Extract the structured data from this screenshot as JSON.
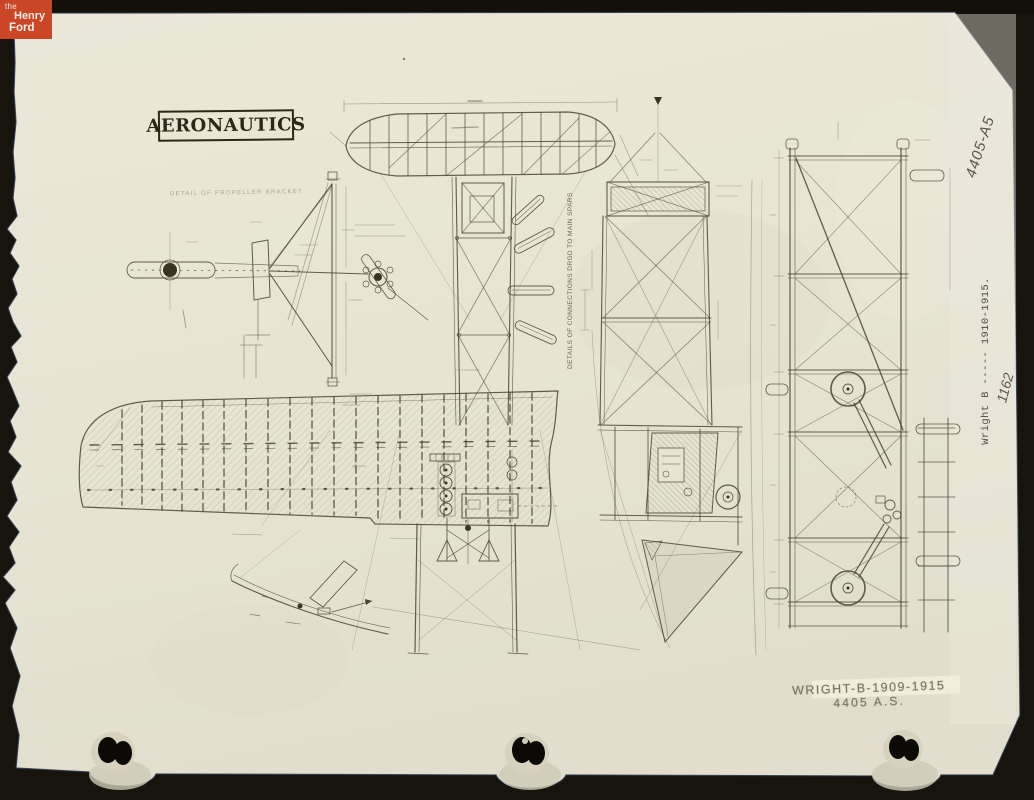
{
  "meta": {
    "background_color": "#17140d",
    "paper_color": "#e8e5d6",
    "ink_color": "#4a4334",
    "logo_color": "#cb4527"
  },
  "logo": {
    "word1": "the",
    "word2": "Henry",
    "word3": "Ford"
  },
  "drawing": {
    "masthead": "AERONAUTICS",
    "caption_propeller_bracket": "DETAIL OF PROPELLER BRACKET",
    "note_connections": "DETAILS OF CONNECTIONS DRGD TO MAIN SPARS"
  },
  "annotations": {
    "pencil_catalog": "4405-A5",
    "typed_label": "Wright B ----- 1910-1915.",
    "pencil_number": "1162",
    "stamp_line1": "WRIGHT-B-1909-1915",
    "stamp_line2": "4405 A.S."
  }
}
